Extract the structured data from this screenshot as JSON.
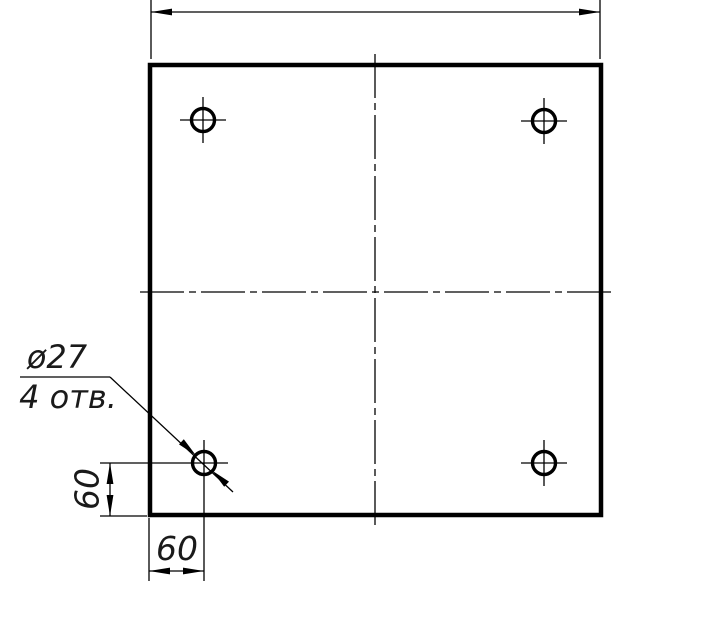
{
  "colors": {
    "ink": "#000000",
    "paper": "#ffffff"
  },
  "callout": {
    "diameter_label": "ø27",
    "count_label": "4 отв."
  },
  "dims": {
    "left_vertical_value": "60",
    "bottom_horizontal_value": "60"
  }
}
